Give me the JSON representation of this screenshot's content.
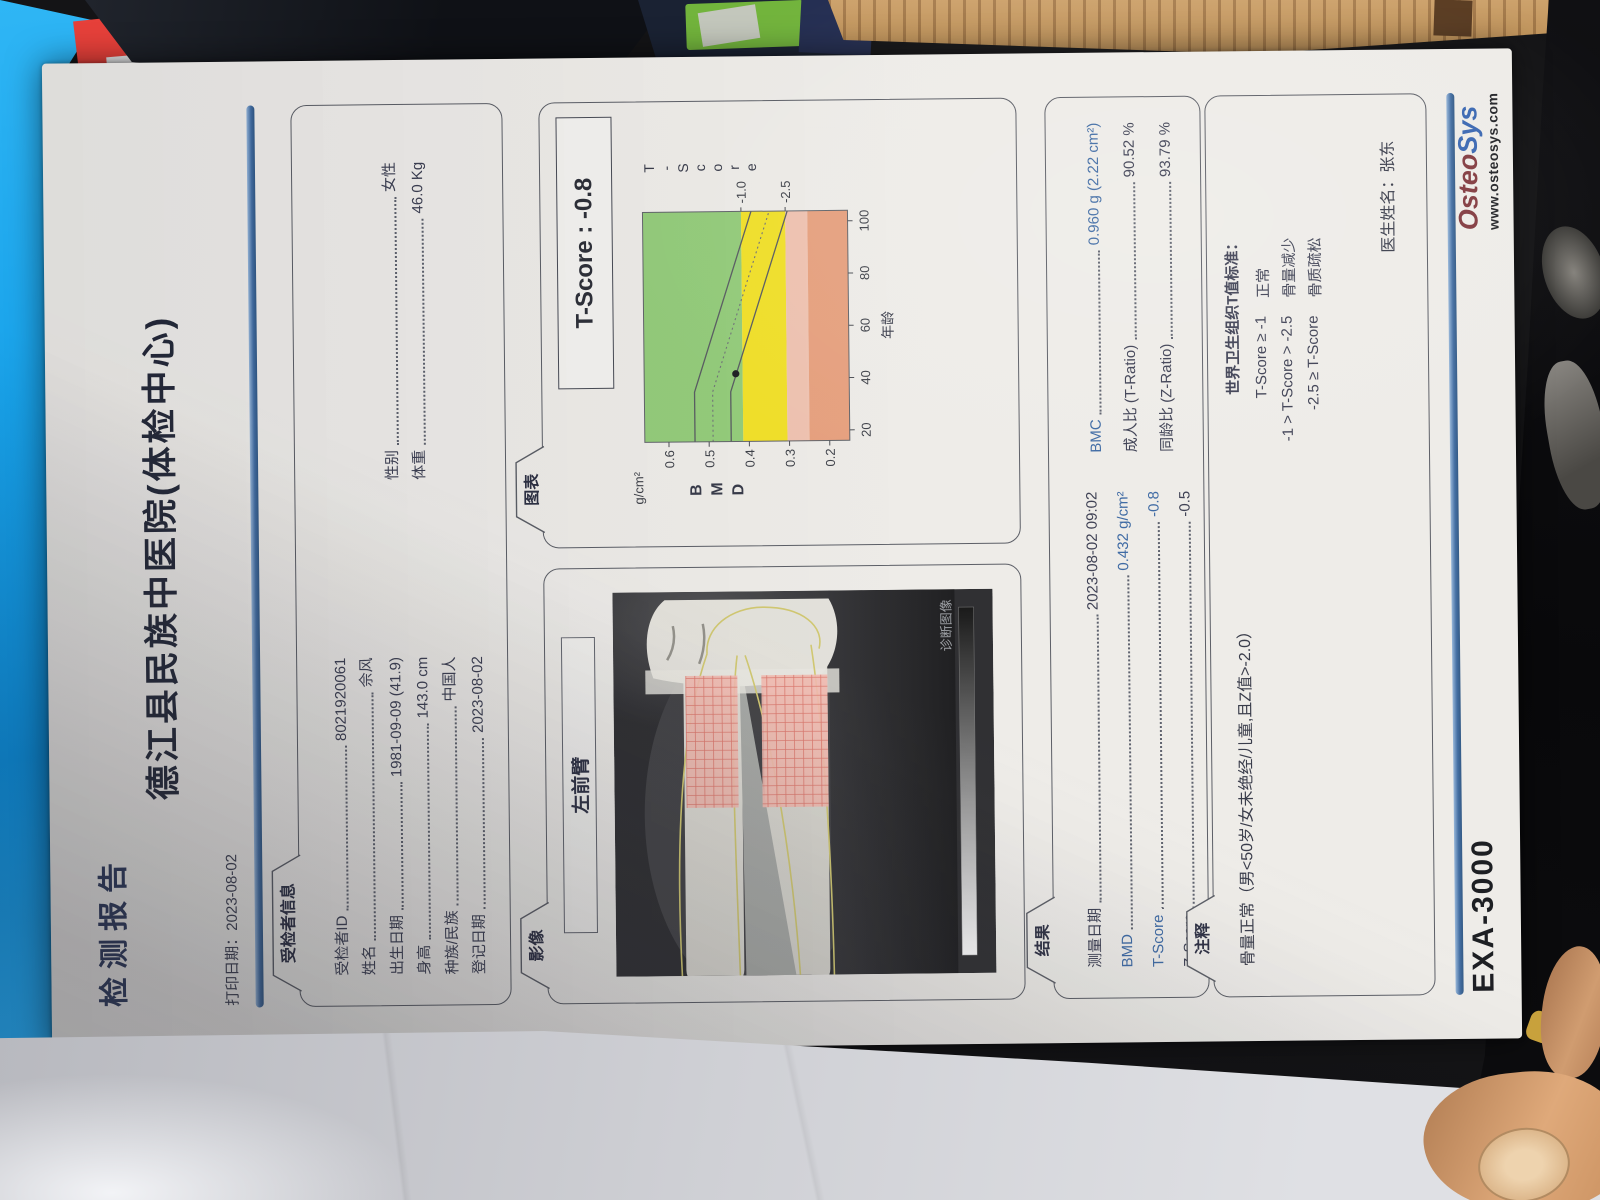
{
  "header": {
    "report_title": "检测报告",
    "print_date_label": "打印日期：",
    "print_date": "2023-08-02",
    "hospital": "德江县民族中医院(体检中心)"
  },
  "patient": {
    "section": "受检者信息",
    "left": [
      {
        "label": "受检者ID",
        "value": "8021920061"
      },
      {
        "label": "姓名",
        "value": "佘风"
      },
      {
        "label": "出生日期",
        "value": "1981-09-09 (41.9)"
      },
      {
        "label": "身高",
        "value": "143.0 cm"
      },
      {
        "label": "种族/民族",
        "value": "中国人"
      },
      {
        "label": "登记日期",
        "value": "2023-08-02"
      }
    ],
    "right": [
      {
        "label": "性别",
        "value": "女性"
      },
      {
        "label": "体重",
        "value": "46.0 Kg"
      }
    ]
  },
  "image_section": {
    "section": "影像",
    "roi_name": "左前臂",
    "watermark": "诊断图像"
  },
  "chart_section": {
    "section": "图表",
    "tscore_box": "T-Score : -0.8"
  },
  "chart_data": {
    "type": "line",
    "xlabel": "年龄",
    "x_ticks": [
      20,
      40,
      60,
      80,
      100
    ],
    "x_range": [
      16,
      104
    ],
    "y_unit": "g/cm²",
    "y_side_label": "BMD",
    "y_ticks": [
      0.6,
      0.5,
      0.4,
      0.3,
      0.2
    ],
    "y_range": [
      0.15,
      0.66
    ],
    "right_axis_label": "T-Score",
    "right_marks": [
      {
        "t": "-1.0",
        "bmd": 0.415
      },
      {
        "t": "-2.5",
        "bmd": 0.305
      }
    ],
    "bands": [
      {
        "from": 0.415,
        "to": 0.66,
        "color": "#8fca74"
      },
      {
        "from": 0.305,
        "to": 0.415,
        "color": "#f2df1f"
      },
      {
        "from": 0.25,
        "to": 0.305,
        "color": "#efc0ad"
      },
      {
        "from": 0.15,
        "to": 0.25,
        "color": "#e69c78"
      }
    ],
    "series": [
      {
        "name": "reference-upper",
        "style": "solid",
        "points": [
          [
            16,
            0.535
          ],
          [
            35,
            0.535
          ],
          [
            104,
            0.39
          ]
        ]
      },
      {
        "name": "reference-mean",
        "style": "dashed",
        "points": [
          [
            16,
            0.49
          ],
          [
            35,
            0.49
          ],
          [
            104,
            0.345
          ]
        ]
      },
      {
        "name": "reference-lower",
        "style": "solid",
        "points": [
          [
            16,
            0.445
          ],
          [
            35,
            0.445
          ],
          [
            104,
            0.3
          ]
        ]
      }
    ],
    "patient_point": {
      "age": 41.9,
      "bmd": 0.432
    }
  },
  "results": {
    "section": "结果",
    "left": [
      {
        "label": "测量日期",
        "value": "2023-08-02 09:02",
        "blue": false
      },
      {
        "label": "BMD",
        "value": "0.432 g/cm²",
        "blue": true
      },
      {
        "label": "T-Score",
        "value": "-0.8",
        "blue": true
      },
      {
        "label": "Z-Score",
        "value": "-0.5",
        "blue": false
      }
    ],
    "right": [
      {
        "label": "BMC",
        "value": "0.960 g (2.22 cm²)",
        "blue": true
      },
      {
        "label": "成人比 (T-Ratio)",
        "value": "90.52 %",
        "blue": false
      },
      {
        "label": "同龄比 (Z-Ratio)",
        "value": "93.79 %",
        "blue": false
      }
    ]
  },
  "notes": {
    "section": "注释",
    "comment": "骨量正常（男<50岁/女未绝经/儿童,且Z值>-2.0）",
    "who_title": "世界卫生组织T值标准：",
    "rows": [
      {
        "cond": "T-Score ≥ -1",
        "name": "正常"
      },
      {
        "cond": "-1 > T-Score > -2.5",
        "name": "骨量减少"
      },
      {
        "cond": "-2.5 ≥ T-Score",
        "name": "骨质疏松"
      }
    ],
    "doctor_label": "医生姓名：",
    "doctor": "张东"
  },
  "footer": {
    "device": "EXA-3000",
    "brand_osteo": "Osteo",
    "brand_sys": "Sys",
    "url": "www.osteosys.com"
  },
  "colors": {
    "accent_blue_rule": "#3a679e",
    "value_blue": "#34629f",
    "brand_maroon": "#7c3036",
    "brand_blue": "#2f5fae"
  }
}
